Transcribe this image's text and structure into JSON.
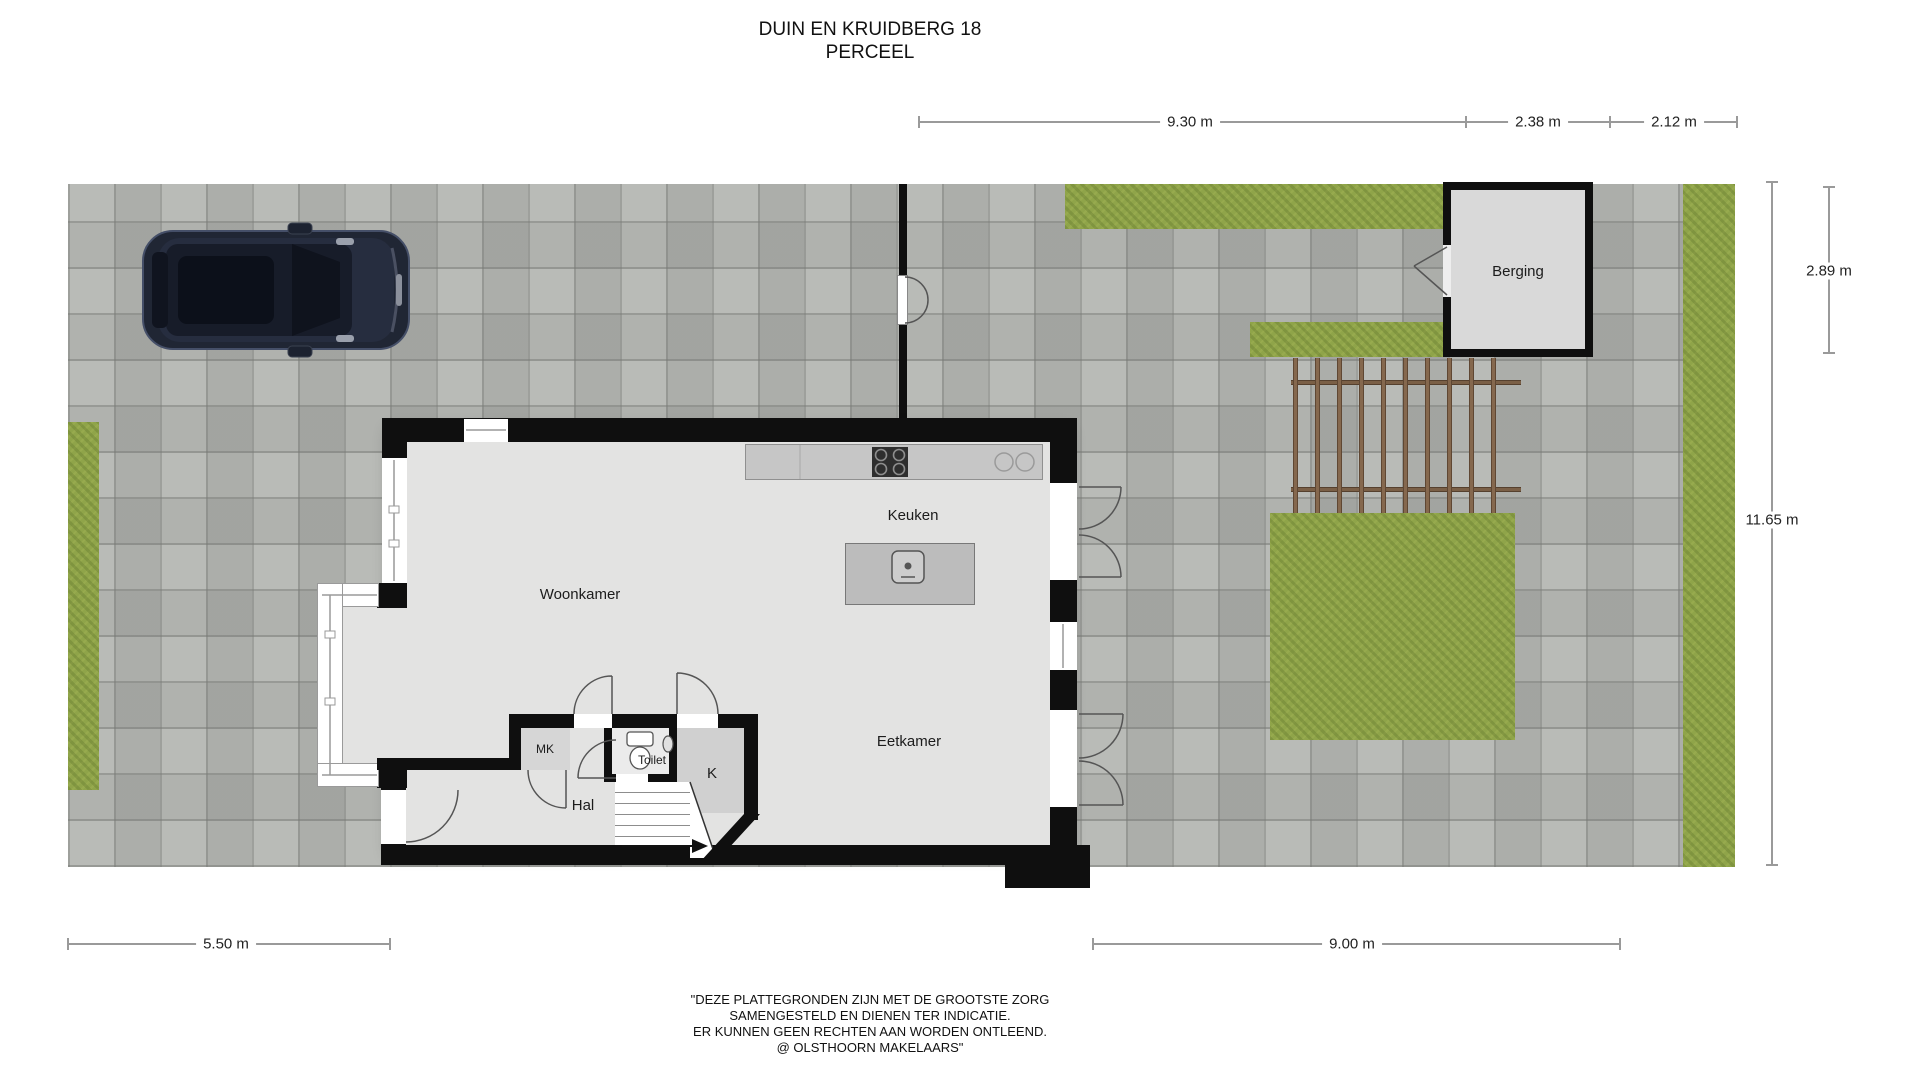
{
  "title": {
    "line1": "DUIN EN KRUIDBERG 18",
    "line2": "PERCEEL"
  },
  "rooms": {
    "woonkamer": "Woonkamer",
    "keuken": "Keuken",
    "eetkamer": "Eetkamer",
    "hal": "Hal",
    "toilet": "Toilet",
    "mk": "MK",
    "k": "K",
    "berging": "Berging"
  },
  "dimensions": {
    "top_1": "9.30 m",
    "top_2": "2.38 m",
    "top_3": "2.12 m",
    "right_shed": "2.89 m",
    "right_plot": "11.65 m",
    "bottom_left": "5.50 m",
    "bottom_right": "9.00 m"
  },
  "disclaimer": {
    "line1": "\"DEZE PLATTEGRONDEN ZIJN MET DE GROOTSTE ZORG",
    "line2": "SAMENGESTELD EN DIENEN TER INDICATIE.",
    "line3": "ER KUNNEN GEEN RECHTEN AAN WORDEN ONTLEEND.",
    "line4": "@ OLSTHOORN MAKELAARS\""
  },
  "colors": {
    "paving": "#b2b4b0",
    "grass": "#8fa449",
    "wall": "#0f0f0f",
    "floor": "#e3e3e2",
    "counter": "#c6c6c6",
    "island": "#bcbcbc",
    "shed_fill": "#d9d9d9",
    "pergola_wood": "#85684e",
    "car_body": "#202634",
    "dimension_line": "#9a9a9a"
  }
}
